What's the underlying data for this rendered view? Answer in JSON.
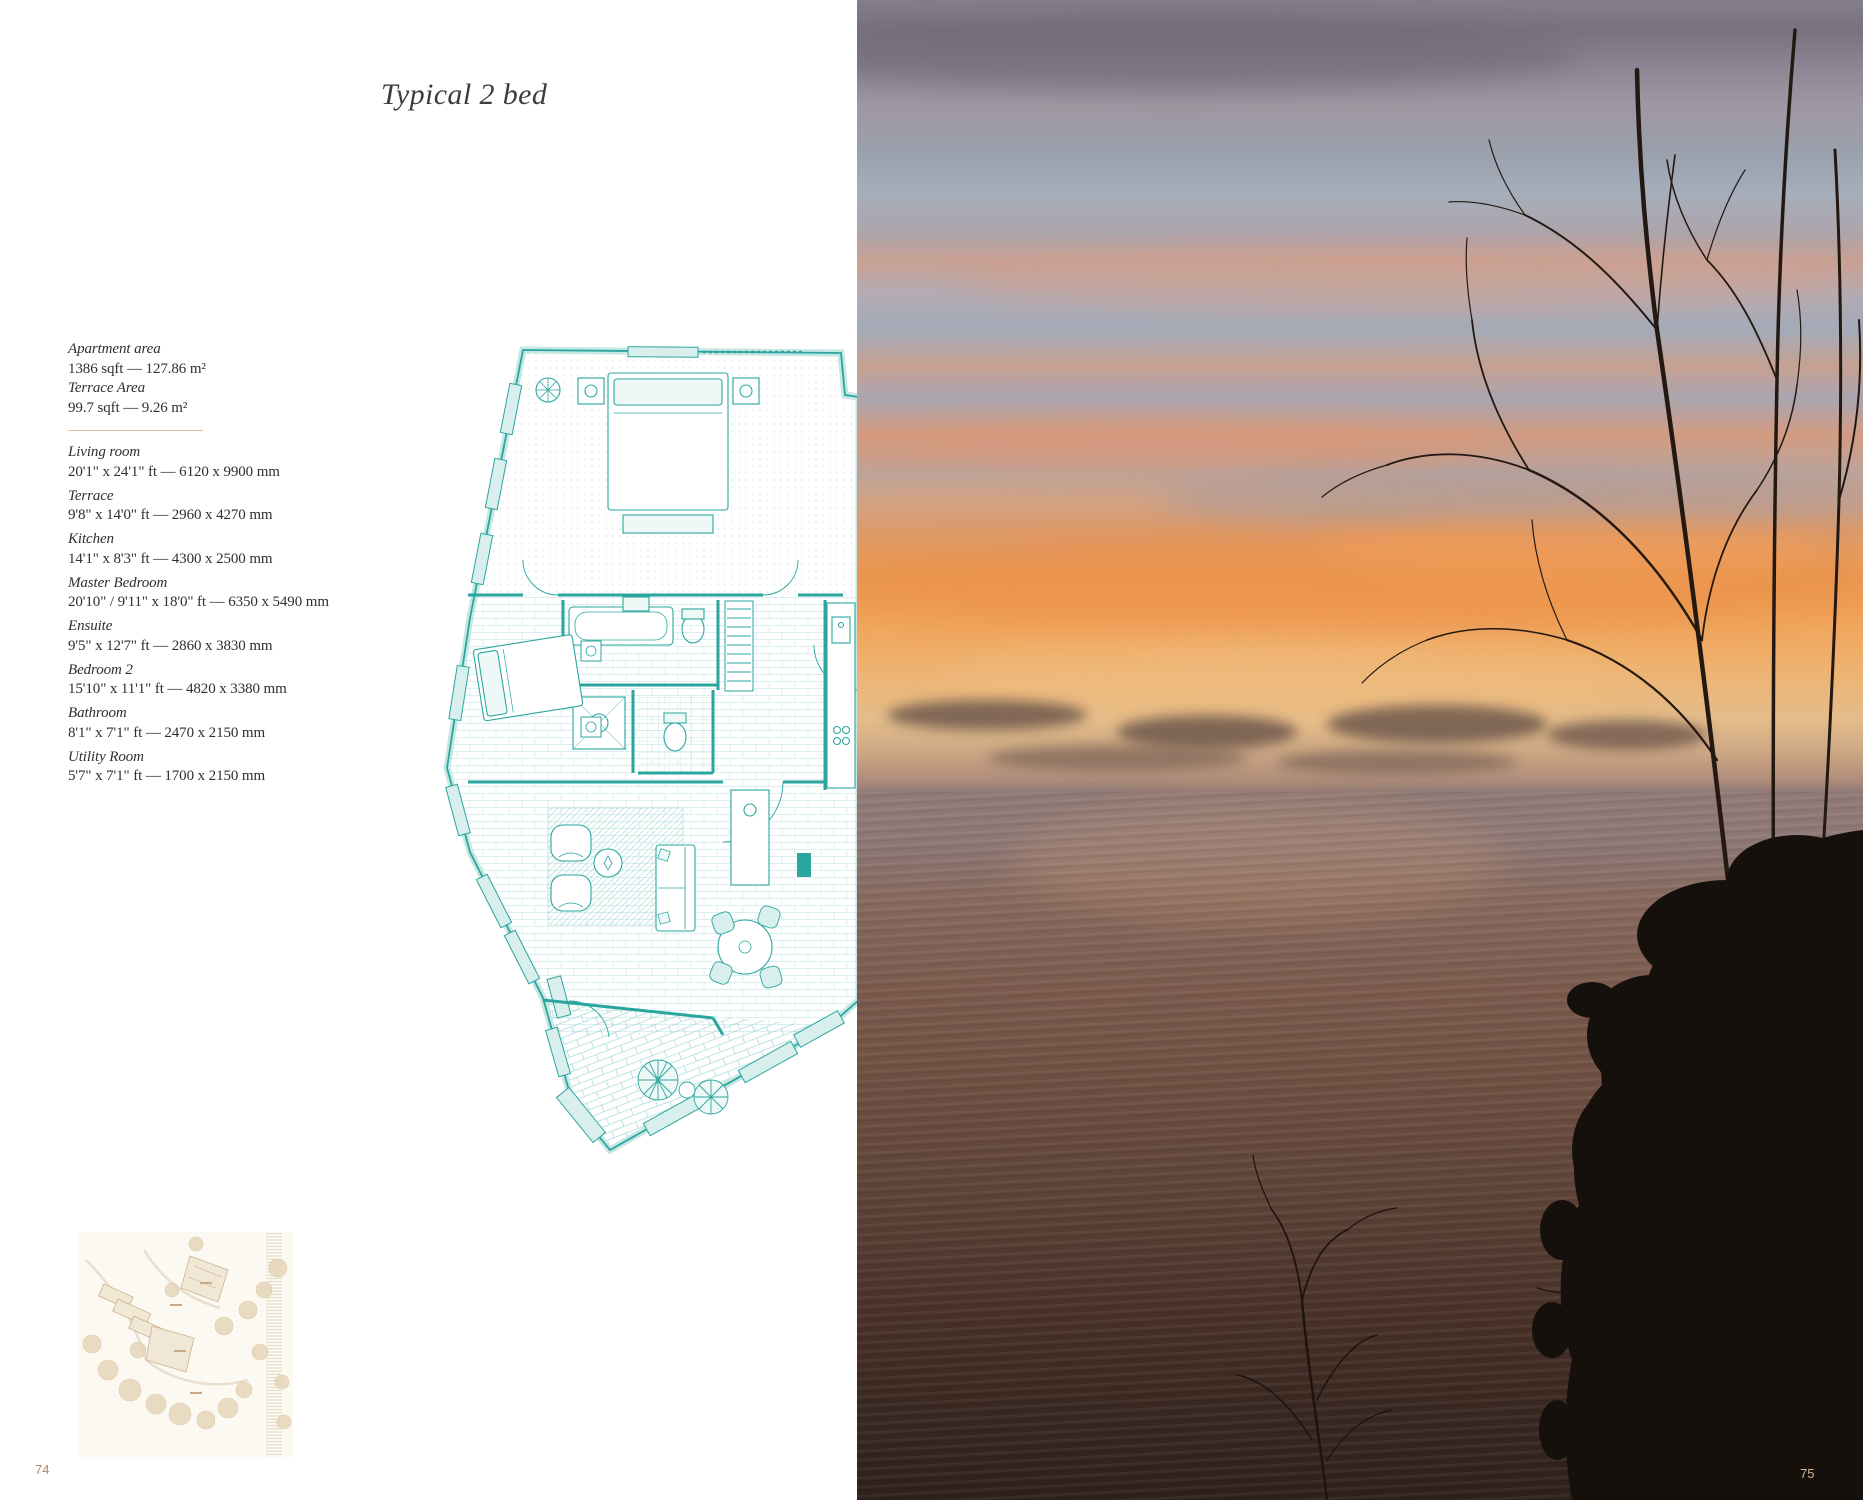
{
  "document": {
    "left_page": {
      "title": "Typical 2 bed",
      "page_number": "74",
      "areas": [
        {
          "label": "Apartment area",
          "value": "1386 sqft — 127.86 m²"
        },
        {
          "label": "Terrace Area",
          "value": "99.7 sqft — 9.26 m²"
        }
      ],
      "rooms": [
        {
          "label": "Living room",
          "value": "20'1\" x 24'1\" ft — 6120 x 9900 mm"
        },
        {
          "label": "Terrace",
          "value": "9'8\" x 14'0\" ft — 2960 x 4270 mm"
        },
        {
          "label": "Kitchen",
          "value": "14'1\" x 8'3\" ft — 4300 x 2500 mm"
        },
        {
          "label": "Master Bedroom",
          "value": "20'10\" / 9'11\" x 18'0\" ft — 6350 x 5490 mm"
        },
        {
          "label": "Ensuite",
          "value": "9'5\" x 12'7\" ft — 2860 x 3830 mm"
        },
        {
          "label": "Bedroom 2",
          "value": "15'10\" x 11'1\" ft — 4820 x 3380 mm"
        },
        {
          "label": "Bathroom",
          "value": "8'1\" x 7'1\" ft — 2470 x 2150 mm"
        },
        {
          "label": "Utility Room",
          "value": "5'7\" x 7'1\" ft — 1700 x 2150 mm"
        }
      ]
    },
    "right_page": {
      "page_number": "75"
    },
    "colors": {
      "floor_plan_teal": "#2aa69f",
      "site_plan_tan": "#cbb291",
      "divider_tan": "#ddbfa3",
      "page_number_left": "#b08a66",
      "page_number_right": "#d8b693"
    }
  }
}
